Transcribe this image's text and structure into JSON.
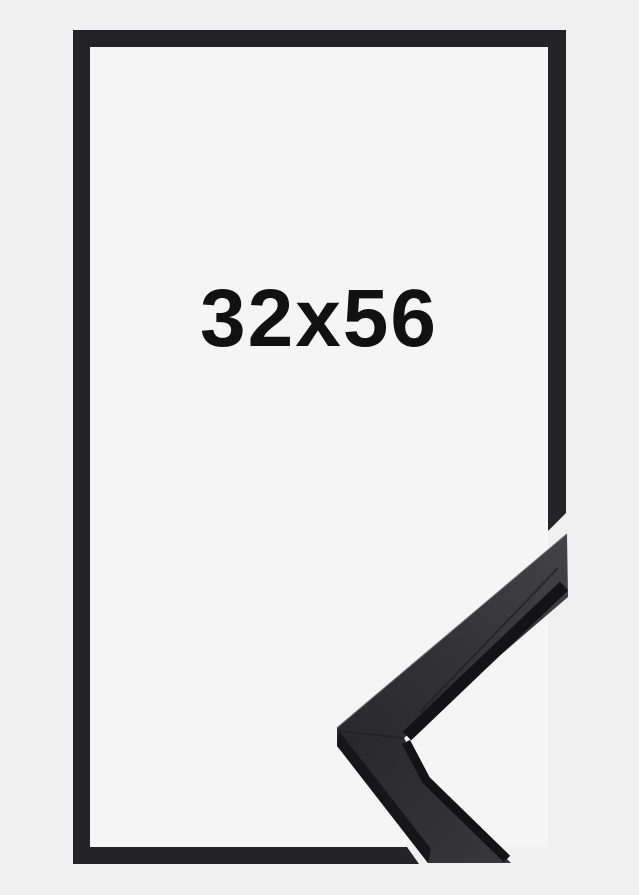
{
  "frame_preview": {
    "size_label": "32x56"
  },
  "colors": {
    "background": "#f0f0f1",
    "inner-background": "#f5f5f6",
    "frame-border": "#242327",
    "moulding-face-light": "#434246",
    "moulding-face-dark": "#29282b",
    "moulding-side": "#161518",
    "moulding-lip": "#131215",
    "label-text": "#111111"
  }
}
